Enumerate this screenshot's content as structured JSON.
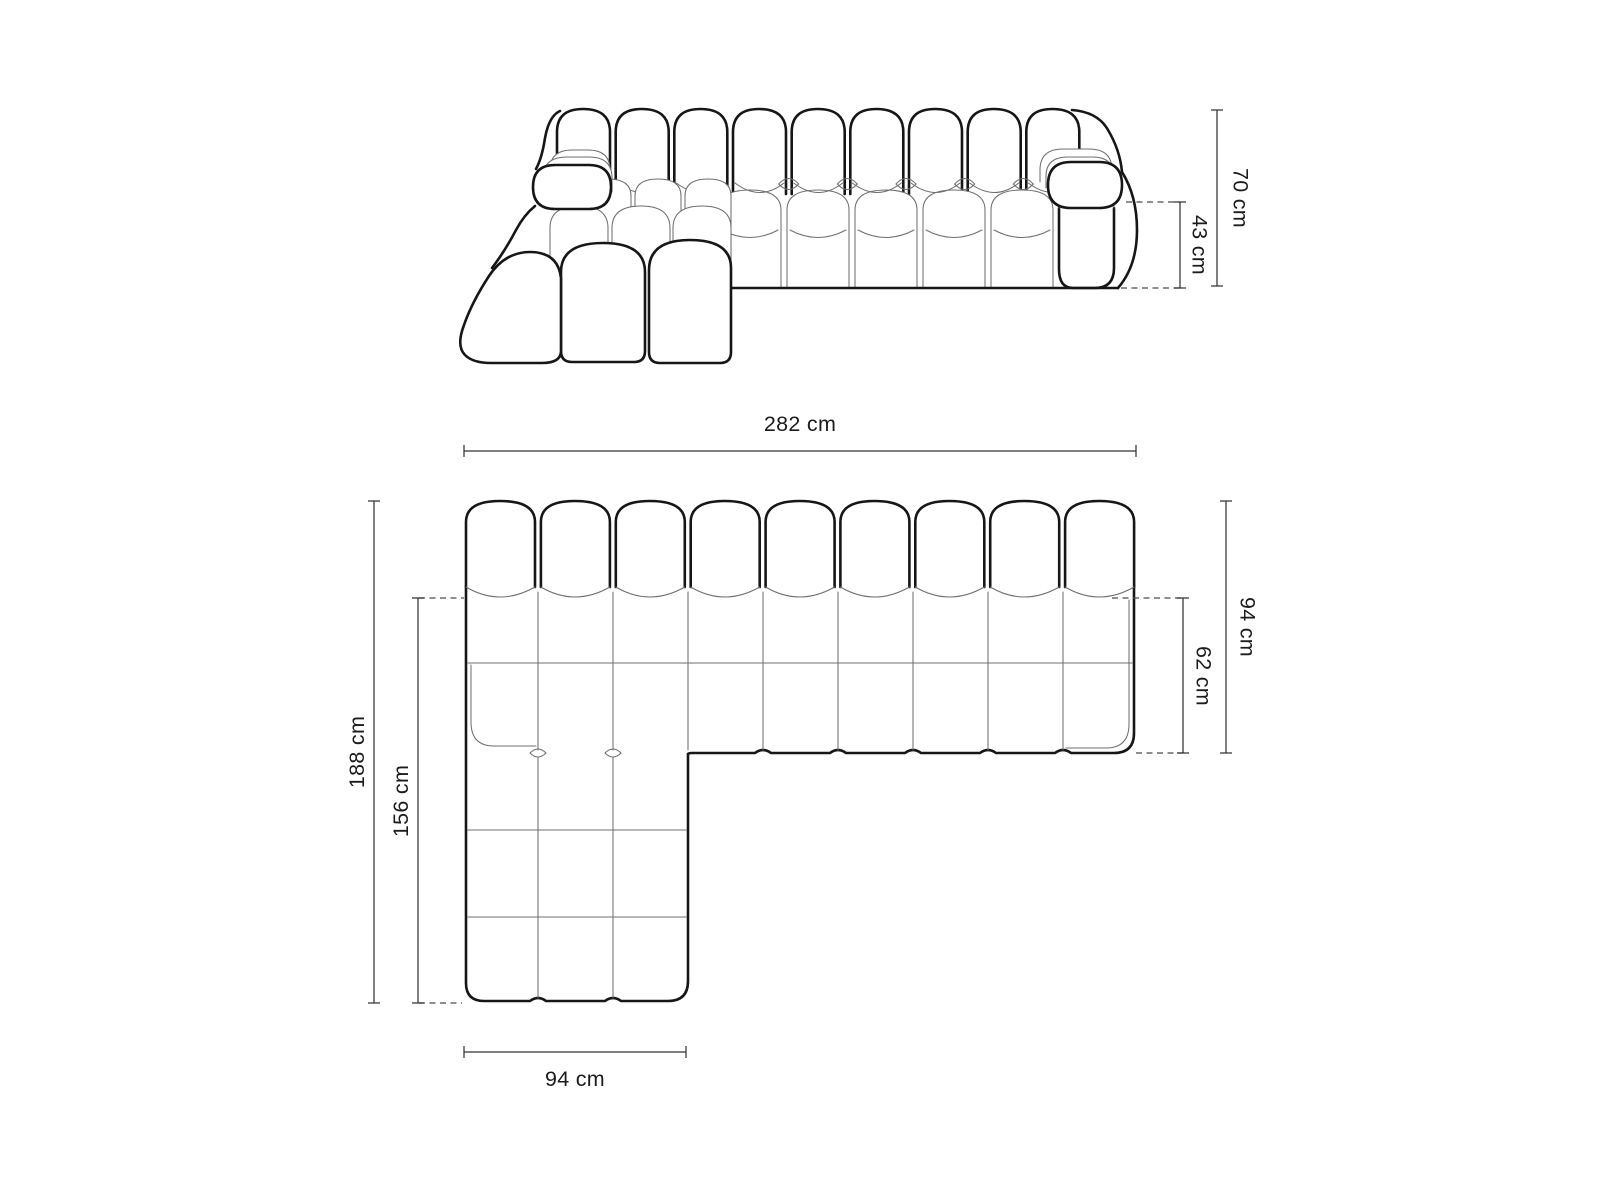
{
  "diagram": {
    "type": "sofa-dimension-drawing",
    "background": "#ffffff",
    "ink_bold": "#161616",
    "ink_thin": "#6f6f6f",
    "ink_dim": "#333333",
    "labels": {
      "front_total_height": "70 cm",
      "front_seat_height": "43 cm",
      "plan_total_width": "282 cm",
      "plan_total_depth": "94 cm",
      "plan_seat_depth": "62 cm",
      "plan_chaise_total_length": "188 cm",
      "plan_chaise_inner_length": "156 cm",
      "plan_chaise_width": "94 cm"
    }
  }
}
